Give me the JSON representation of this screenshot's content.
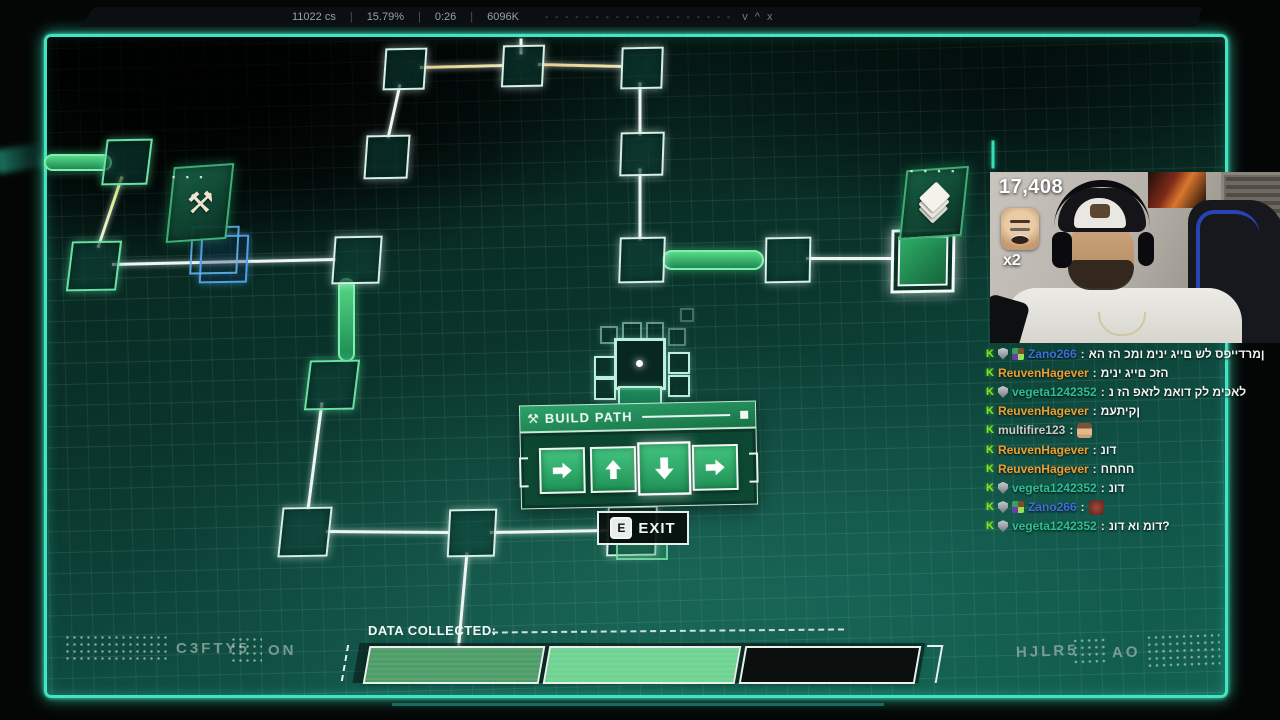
{
  "hud": {
    "stats": [
      "11022 cs",
      "15.79%",
      "0:26",
      "6096K"
    ],
    "separator": "|",
    "dashes": "- - - - - - - - - - - - - - - - - - -",
    "controls": "v ^ x"
  },
  "dialog": {
    "title": "BUILD PATH",
    "icon": "hammer-icon",
    "arrows": [
      "right",
      "up",
      "down",
      "right"
    ],
    "selected_index": 2
  },
  "exit": {
    "key": "E",
    "label": "EXIT"
  },
  "footer": {
    "label": "DATA COLLECTED:",
    "segments": [
      {
        "state": "filled",
        "color": "#4f9d68"
      },
      {
        "state": "filled",
        "color": "#6fd392"
      },
      {
        "state": "empty",
        "color": "#0b100e"
      }
    ],
    "left_code": "C3FTY5",
    "left_status": "ON",
    "right_code": "HJLR5",
    "right_status": "AO"
  },
  "webcam": {
    "counter": "17,408",
    "multiplier": "x2"
  },
  "chat": {
    "user_colors": {
      "blue": "#3d6fdb",
      "orange": "#f09f2e",
      "green": "#2fbf91",
      "gray": "#cfc9c2"
    },
    "colon": ":",
    "messages": [
      {
        "user": "Zano266",
        "color": "blue",
        "badges": [
          "sword",
          "shield",
          "sub"
        ],
        "text": "אה זה כמו מיני גיים של ספיידרמן"
      },
      {
        "user": "ReuvenHagever",
        "color": "orange",
        "badges": [
          "sword"
        ],
        "text": "מיני גיים כזה"
      },
      {
        "user": "vegeta1242352",
        "color": "green",
        "badges": [
          "sword",
          "shield"
        ],
        "text": "נ זה פאזל מאוד קל מיכאל"
      },
      {
        "user": "ReuvenHagever",
        "color": "orange",
        "badges": [
          "sword"
        ],
        "text": "מעתיקן"
      },
      {
        "user": "multifire123",
        "color": "gray",
        "badges": [
          "sword"
        ],
        "emote": "face"
      },
      {
        "user": "ReuvenHagever",
        "color": "orange",
        "badges": [
          "sword"
        ],
        "text": "נוד"
      },
      {
        "user": "ReuvenHagever",
        "color": "orange",
        "badges": [
          "sword"
        ],
        "text": "חחחח"
      },
      {
        "user": "vegeta1242352",
        "color": "green",
        "badges": [
          "sword",
          "shield"
        ],
        "text": "נוד"
      },
      {
        "user": "Zano266",
        "color": "blue",
        "badges": [
          "sword",
          "shield",
          "sub"
        ],
        "emote": "red"
      },
      {
        "user": "vegeta1242352",
        "color": "green",
        "badges": [
          "sword",
          "shield"
        ],
        "text": "נוד או מוד?"
      }
    ]
  },
  "map": {
    "mining_card_glyph": "⚒",
    "mining_dots": "▪ ▪ ▪",
    "layers_dots": "▪ ▪ ▪ ▪",
    "nodes": [
      {
        "x": 125,
        "y": 160,
        "s": 42,
        "style": "green",
        "skew": -8
      },
      {
        "x": 92,
        "y": 264,
        "s": 46,
        "style": "green",
        "skew": -8
      },
      {
        "x": 222,
        "y": 257,
        "s": 44,
        "style": "blue",
        "skew": -4
      },
      {
        "x": 355,
        "y": 258,
        "s": 44,
        "style": "white",
        "skew": -5
      },
      {
        "x": 330,
        "y": 383,
        "s": 46,
        "style": "green",
        "skew": -8
      },
      {
        "x": 303,
        "y": 530,
        "s": 46,
        "style": "white",
        "skew": -7
      },
      {
        "x": 470,
        "y": 531,
        "s": 44,
        "style": "white",
        "skew": -4
      },
      {
        "x": 630,
        "y": 529,
        "s": 46,
        "style": "white",
        "skew": -3
      },
      {
        "x": 403,
        "y": 67,
        "s": 38,
        "style": "white",
        "skew": -5
      },
      {
        "x": 521,
        "y": 64,
        "s": 38,
        "style": "white",
        "skew": -4
      },
      {
        "x": 640,
        "y": 66,
        "s": 38,
        "style": "white",
        "skew": -3
      },
      {
        "x": 385,
        "y": 155,
        "s": 40,
        "style": "white",
        "skew": -5
      },
      {
        "x": 640,
        "y": 152,
        "s": 40,
        "style": "white",
        "skew": -3
      },
      {
        "x": 640,
        "y": 258,
        "s": 42,
        "style": "white",
        "skew": -3
      },
      {
        "x": 786,
        "y": 258,
        "s": 42,
        "style": "white",
        "skew": -2
      },
      {
        "x": 920,
        "y": 258,
        "s": 58,
        "style": "goal",
        "skew": -2
      },
      {
        "x": 456,
        "y": 681,
        "s": 62,
        "style": "bottomblue",
        "skew": -4
      }
    ],
    "lines": [
      {
        "x1": 521,
        "y1": 38,
        "x2": 521,
        "y2": 54,
        "c": ""
      },
      {
        "x1": 420,
        "y1": 67,
        "x2": 504,
        "y2": 65,
        "c": "yellow"
      },
      {
        "x1": 538,
        "y1": 64,
        "x2": 623,
        "y2": 66,
        "c": "yellow"
      },
      {
        "x1": 400,
        "y1": 84,
        "x2": 388,
        "y2": 138,
        "c": ""
      },
      {
        "x1": 640,
        "y1": 82,
        "x2": 640,
        "y2": 135,
        "c": ""
      },
      {
        "x1": 640,
        "y1": 168,
        "x2": 640,
        "y2": 240,
        "c": ""
      },
      {
        "x1": 122,
        "y1": 176,
        "x2": 98,
        "y2": 247,
        "c": "lime"
      },
      {
        "x1": 112,
        "y1": 264,
        "x2": 336,
        "y2": 259,
        "c": ""
      },
      {
        "x1": 322,
        "y1": 402,
        "x2": 308,
        "y2": 509,
        "c": ""
      },
      {
        "x1": 326,
        "y1": 531,
        "x2": 450,
        "y2": 532,
        "c": ""
      },
      {
        "x1": 490,
        "y1": 532,
        "x2": 608,
        "y2": 530,
        "c": ""
      },
      {
        "x1": 467,
        "y1": 552,
        "x2": 457,
        "y2": 664,
        "c": ""
      },
      {
        "x1": 806,
        "y1": 258,
        "x2": 892,
        "y2": 258,
        "c": ""
      },
      {
        "x1": 993,
        "y1": 140,
        "x2": 993,
        "y2": 168,
        "c": "teal"
      }
    ],
    "pills": [
      {
        "x": 44,
        "y": 154,
        "w": 64,
        "h": 13
      },
      {
        "x": 338,
        "y": 278,
        "w": 13,
        "h": 80
      },
      {
        "x": 662,
        "y": 250,
        "w": 98,
        "h": 16
      }
    ]
  }
}
